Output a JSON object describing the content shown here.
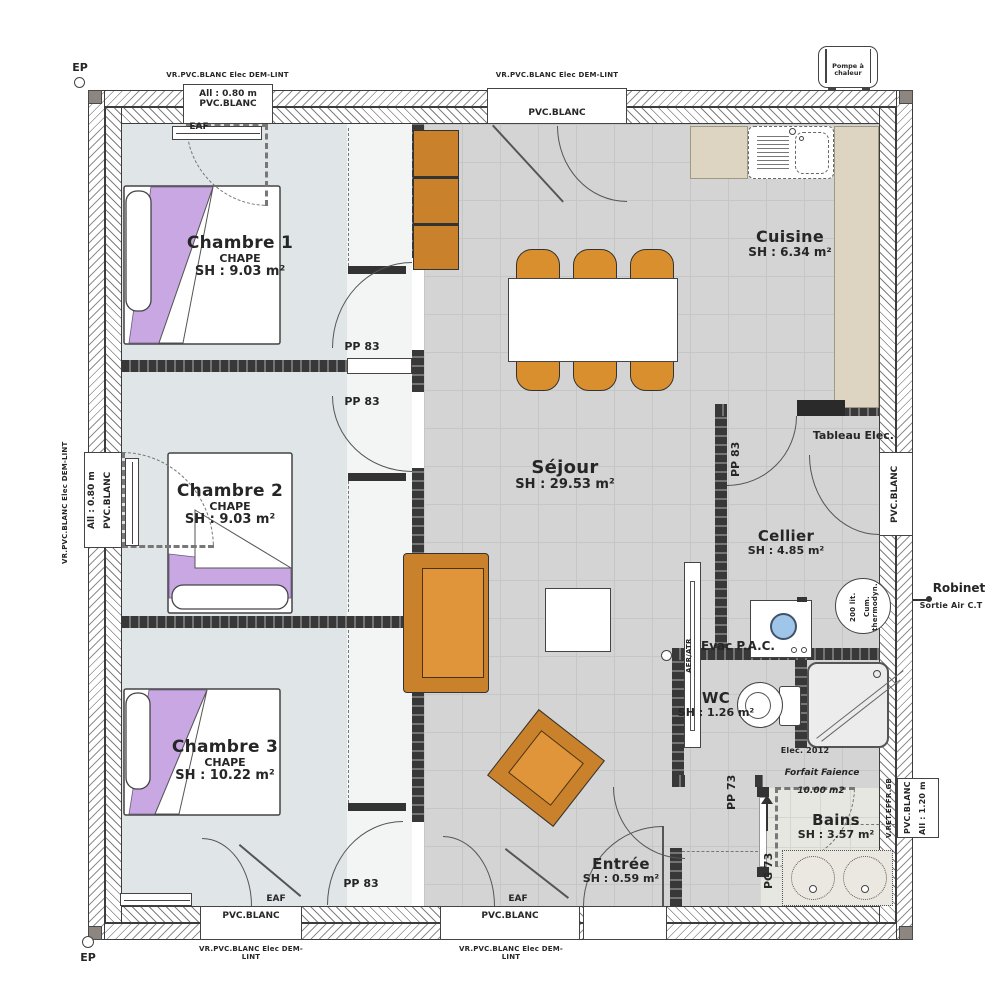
{
  "rooms": {
    "chambre1": {
      "name": "Chambre 1",
      "screed": "CHAPE",
      "area": "SH : 9.03 m²"
    },
    "chambre2": {
      "name": "Chambre 2",
      "screed": "CHAPE",
      "area": "SH : 9.03 m²"
    },
    "chambre3": {
      "name": "Chambre 3",
      "screed": "CHAPE",
      "area": "SH : 10.22 m²"
    },
    "sejour": {
      "name": "Séjour",
      "area": "SH : 29.53 m²"
    },
    "cuisine": {
      "name": "Cuisine",
      "area": "SH : 6.34 m²"
    },
    "cellier": {
      "name": "Cellier",
      "area": "SH : 4.85 m²"
    },
    "wc": {
      "name": "WC",
      "area": "SH : 1.26 m²"
    },
    "bains": {
      "name": "Bains",
      "area": "SH : 3.57 m²"
    },
    "entree": {
      "name": "Entrée",
      "area": "SH : 0.59 m²"
    }
  },
  "doors": {
    "pp83": "PP 83",
    "pp73": "PP 73",
    "pg73": "PG 73"
  },
  "windows": {
    "roller_note": "VR.PVC.BLANC Elec DEM-LINT",
    "pvc": "PVC.BLANC",
    "sill_080": "All : 0.80 m",
    "sill_120": "All : 1.20 m",
    "eaf": "EAF",
    "fixed_note": "V.RET.EFFR.GB"
  },
  "markers": {
    "ep": "EP"
  },
  "equipment": {
    "heat_pump": "Pompe à chaleur",
    "elec_panel": "Tableau Elec.",
    "evac": "Evac P.A.C.",
    "boiler_l1": "200 lit.",
    "boiler_l2": "Cum. thermodyn.",
    "tap": "Robinet",
    "air_out": "Sortie Air C.T",
    "vent": "AER/ATR",
    "elec_year": "Elec. 2012",
    "tiling_l1": "Forfait Faience",
    "tiling_l2": "10.00 m2"
  },
  "colors": {
    "furniture": "#c9812b",
    "blanket": "#c9a7e2",
    "floor_bedroom": "#e0e5e8",
    "floor_tile": "#d3d4d3",
    "counter": "#ddd5c1",
    "wall": "#383838"
  }
}
